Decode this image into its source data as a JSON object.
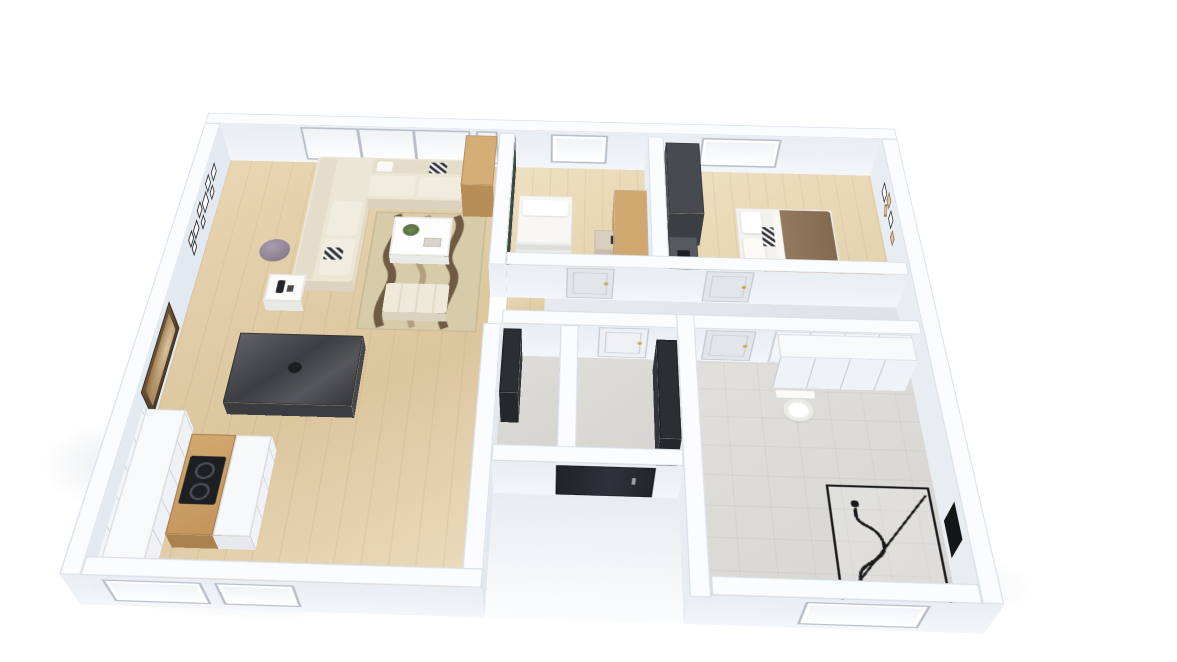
{
  "scene": {
    "description": "3D isometric cutaway (dollhouse) floor plan render of an apartment on a white background",
    "view": "axonometric top-down cutaway, walls cut at waist height",
    "background": "#ffffff"
  },
  "colors": {
    "wall_face": "#edf2f8",
    "wall_top": "#fafcff",
    "wall_shadow": "#d8e0ea",
    "floor_wood": "#e2cfa9",
    "floor_wood_light": "#e9d8b6",
    "floor_hall_gray": "#e3e7ed",
    "floor_tile": "#dad9d5",
    "accent_wall_green": "#3d4a42",
    "sofa_cream": "#ece6d7",
    "rug_base": "#d8cbaa",
    "rug_wave": "#6e5b41",
    "rug_wave_light": "#b3a07f",
    "wood_furniture": "#c89f68",
    "dark_furniture": "#26292d",
    "door_panel_gray": "#e2e5ea",
    "door_panel_white": "#eef0f3",
    "handle_gold": "#c7a64e",
    "front_door_black": "#23262b",
    "shower_frame": "#17181a",
    "bed_blanket_brown": "#8a7157",
    "lamp_shade_purple": "#8f8496",
    "dining_table_glass": "#4a4c4f",
    "chair_gray": "#bdbab1"
  },
  "rooms": [
    {
      "name": "living-room",
      "floor": "wood",
      "furniture": [
        "corner-sofa-cream",
        "zigzag-throw-pillows",
        "coffee-table-white",
        "potted-plant",
        "wavy-area-rug",
        "floor-lamp-purple",
        "side-table-white",
        "ottoman-bench",
        "gallery-picture-frames",
        "floral-relief-art-panel",
        "panoramic-window-wall",
        "tall-wood-cabinet"
      ]
    },
    {
      "name": "dining-area",
      "floor": "wood",
      "furniture": [
        "glass-dining-table",
        "six-upholstered-chairs"
      ]
    },
    {
      "name": "kitchen",
      "floor": "wood",
      "furniture": [
        "white-wall-cabinets",
        "wood-island-counter",
        "black-cooktop-two-burners",
        "two-exterior-windows"
      ]
    },
    {
      "name": "bedroom-1",
      "floor": "light-wood",
      "furniture": [
        "green-accent-wall",
        "single-bed-white",
        "desk",
        "black-office-chair",
        "wood-wardrobe",
        "skylight-window"
      ]
    },
    {
      "name": "bedroom-2",
      "floor": "light-wood",
      "furniture": [
        "dark-wardrobe",
        "desk-with-monitor",
        "black-office-chair",
        "bed-brown-duvet-white-pillows",
        "wood-desk-at-bed-foot",
        "wall-picture-frames",
        "skylight-window"
      ]
    },
    {
      "name": "hallway",
      "floor": "gray",
      "furniture": [
        "bedroom-door-1",
        "bedroom-door-2"
      ]
    },
    {
      "name": "pantry",
      "floor": "gray",
      "furniture": [
        "storage-shelves-with-jars",
        "tall-dark-cabinet"
      ]
    },
    {
      "name": "entry-hall",
      "floor": "gray",
      "furniture": [
        "white-interior-door",
        "dark-wardrobe",
        "black-front-door"
      ]
    },
    {
      "name": "bathroom",
      "floor": "tile",
      "furniture": [
        "interior-door",
        "tall-white-cabinets",
        "wall-hung-toilet",
        "walk-in-shower-black-frame",
        "black-shower-fixture",
        "skylight-window"
      ]
    }
  ]
}
